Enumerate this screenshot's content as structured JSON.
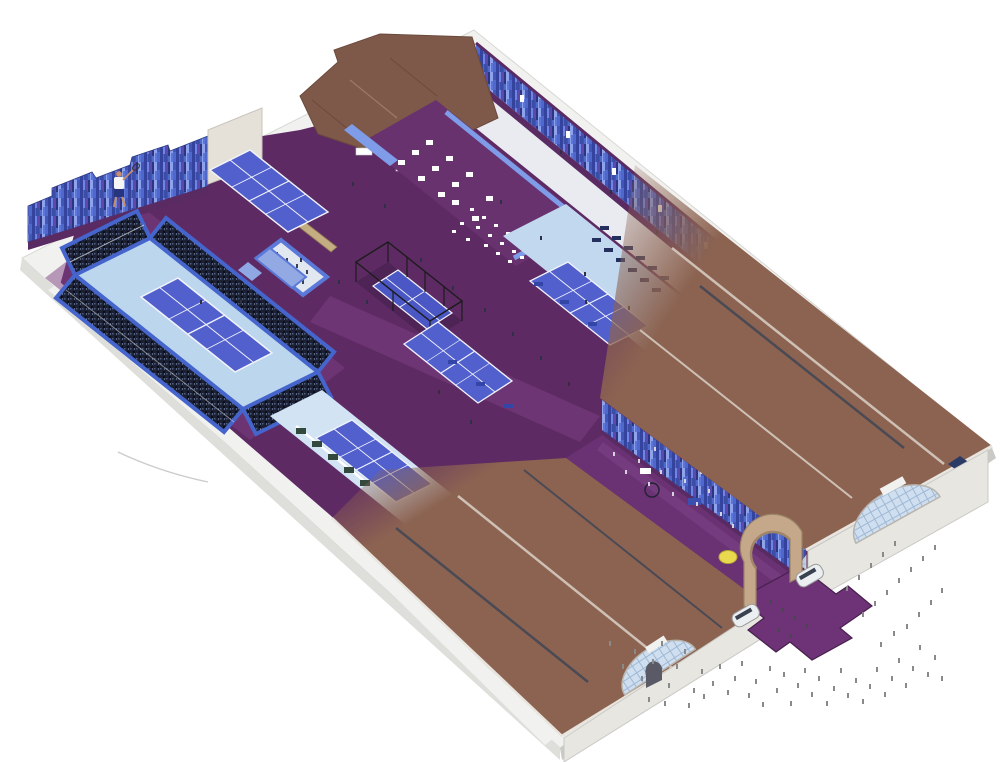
{
  "meta": {
    "description": "Isometric cutaway illustration of an indoor racquet-sports venue: show-court stadium with crowded stands, practice courts, fenced court, cafe seating, purple concourse between brown warehouse roofs, arched entrance with queuing crowds and food trucks"
  },
  "palette": {
    "bg": "#ffffff",
    "concrete_light": "#f1f1ef",
    "concrete_mid": "#dededa",
    "concrete_dark": "#c9c9c5",
    "floor_purple": "#5e2a64",
    "floor_purple_light": "#7b3e82",
    "platform_purple": "#68326f",
    "concourse_purple": "#6a3173",
    "carpet_purple": "#6e3377",
    "purple_band": "#5a2a62",
    "roof_brown": "#8c6351",
    "roof_brown_dark": "#7e5949",
    "roof_ridge": "#cfc0b6",
    "skylight_dark": "#4a4a55",
    "court_blue": "#5260ce",
    "court_blue_deep": "#4b57c4",
    "apron_blue": "#c2d8ee",
    "apron_blue_light": "#d2e3f4",
    "stadium_apron": "#bcd6ee",
    "wall_blue": "#4f68cc",
    "stands_wall": "#4565cd",
    "pale_floor": "#e9ebf1",
    "line_white": "#f2f4fa",
    "fence_black": "#1c1c1c",
    "tan_sand": "#c5ad82",
    "arch_tan": "#c5a88a",
    "arch_tan_dark": "#a08569",
    "ball_yellow": "#e9d94e",
    "figure_gray": "#8a8a8a",
    "figure_dark": "#2f2f45",
    "figure_light": "#d8d2de",
    "figure_carpet": "#4a4550",
    "figure_platform": "#39405c",
    "truck_white": "#eceff1",
    "glaze_blue": "#cfdff0",
    "glaze_line": "#9fb8d4",
    "green_planter": "#33493d",
    "bench_blue": "#3346a8",
    "bench_navy": "#23305e",
    "rail_blue": "#7f9ce8",
    "skin": "#c98e6a",
    "shirt_white": "#f5f5f5",
    "shorts_navy": "#27357f",
    "table_white": "#ffffff"
  },
  "people": {
    "outside": [
      [
        609,
        641
      ],
      [
        622,
        664
      ],
      [
        634,
        649
      ],
      [
        641,
        676
      ],
      [
        652,
        659
      ],
      [
        661,
        641
      ],
      [
        668,
        683
      ],
      [
        676,
        664
      ],
      [
        684,
        649
      ],
      [
        693,
        688
      ],
      [
        701,
        669
      ],
      [
        648,
        697
      ],
      [
        664,
        701
      ],
      [
        688,
        703
      ],
      [
        703,
        694
      ],
      [
        712,
        681
      ],
      [
        719,
        664
      ],
      [
        727,
        690
      ],
      [
        734,
        676
      ],
      [
        741,
        661
      ],
      [
        748,
        693
      ],
      [
        755,
        679
      ],
      [
        762,
        702
      ],
      [
        769,
        666
      ],
      [
        776,
        688
      ],
      [
        783,
        672
      ],
      [
        790,
        701
      ],
      [
        797,
        683
      ],
      [
        804,
        668
      ],
      [
        811,
        692
      ],
      [
        818,
        676
      ],
      [
        826,
        701
      ],
      [
        833,
        686
      ],
      [
        840,
        668
      ],
      [
        847,
        693
      ],
      [
        855,
        678
      ],
      [
        862,
        699
      ],
      [
        869,
        684
      ],
      [
        876,
        667
      ],
      [
        884,
        692
      ],
      [
        891,
        676
      ],
      [
        898,
        658
      ],
      [
        905,
        683
      ],
      [
        912,
        666
      ],
      [
        919,
        645
      ],
      [
        927,
        672
      ],
      [
        934,
        655
      ],
      [
        941,
        676
      ],
      [
        880,
        642
      ],
      [
        893,
        631
      ],
      [
        906,
        624
      ],
      [
        918,
        612
      ],
      [
        930,
        600
      ],
      [
        941,
        588
      ],
      [
        862,
        612
      ],
      [
        874,
        601
      ],
      [
        886,
        590
      ],
      [
        898,
        578
      ],
      [
        910,
        567
      ],
      [
        922,
        556
      ],
      [
        934,
        545
      ],
      [
        846,
        586
      ],
      [
        858,
        575
      ],
      [
        870,
        563
      ],
      [
        882,
        552
      ],
      [
        894,
        541
      ]
    ],
    "concourse": [
      [
        613,
        452
      ],
      [
        625,
        470
      ],
      [
        638,
        459
      ],
      [
        648,
        482
      ],
      [
        660,
        470
      ],
      [
        672,
        492
      ],
      [
        684,
        479
      ],
      [
        696,
        502
      ],
      [
        708,
        489
      ],
      [
        720,
        512
      ],
      [
        732,
        524
      ],
      [
        744,
        536
      ],
      [
        700,
        470
      ],
      [
        654,
        447
      ]
    ],
    "interior": [
      [
        352,
        182
      ],
      [
        384,
        204
      ],
      [
        300,
        258
      ],
      [
        338,
        280
      ],
      [
        366,
        300
      ],
      [
        420,
        258
      ],
      [
        452,
        286
      ],
      [
        484,
        308
      ],
      [
        512,
        332
      ],
      [
        540,
        356
      ],
      [
        568,
        382
      ],
      [
        500,
        200
      ],
      [
        540,
        236
      ],
      [
        584,
        272
      ],
      [
        628,
        306
      ],
      [
        560,
        150
      ],
      [
        610,
        190
      ],
      [
        656,
        230
      ],
      [
        470,
        420
      ],
      [
        438,
        390
      ],
      [
        240,
        300
      ],
      [
        282,
        336
      ],
      [
        200,
        300
      ],
      [
        585,
        300
      ]
    ],
    "platform": [
      [
        276,
        252
      ],
      [
        286,
        258
      ],
      [
        296,
        264
      ],
      [
        306,
        270
      ],
      [
        282,
        268
      ],
      [
        292,
        274
      ],
      [
        302,
        280
      ],
      [
        272,
        262
      ]
    ],
    "carpet": [
      [
        770,
        600
      ],
      [
        782,
        608
      ],
      [
        794,
        616
      ],
      [
        806,
        624
      ],
      [
        778,
        628
      ],
      [
        790,
        634
      ]
    ]
  },
  "furniture": {
    "cafe_tables": [
      [
        398,
        160
      ],
      [
        418,
        176
      ],
      [
        438,
        192
      ],
      [
        412,
        150
      ],
      [
        432,
        166
      ],
      [
        452,
        182
      ],
      [
        426,
        140
      ],
      [
        446,
        156
      ],
      [
        466,
        172
      ],
      [
        452,
        200
      ],
      [
        472,
        216
      ],
      [
        486,
        196
      ]
    ],
    "dining_chairs": [
      [
        470,
        208
      ],
      [
        482,
        216
      ],
      [
        494,
        224
      ],
      [
        506,
        232
      ],
      [
        476,
        226
      ],
      [
        488,
        234
      ],
      [
        500,
        242
      ],
      [
        512,
        250
      ],
      [
        484,
        244
      ],
      [
        496,
        252
      ],
      [
        508,
        260
      ],
      [
        520,
        256
      ],
      [
        460,
        222
      ],
      [
        466,
        238
      ],
      [
        452,
        230
      ],
      [
        524,
        240
      ]
    ],
    "tr_benches": [
      [
        592,
        238
      ],
      [
        604,
        248
      ],
      [
        616,
        258
      ],
      [
        628,
        268
      ],
      [
        640,
        278
      ],
      [
        652,
        288
      ],
      [
        600,
        226
      ],
      [
        612,
        236
      ],
      [
        624,
        246
      ],
      [
        636,
        256
      ],
      [
        648,
        266
      ],
      [
        660,
        276
      ]
    ],
    "court_benches": [
      [
        448,
        360
      ],
      [
        476,
        382
      ],
      [
        504,
        404
      ],
      [
        560,
        300
      ],
      [
        588,
        322
      ],
      [
        534,
        282
      ]
    ],
    "planters": [
      [
        296,
        428
      ],
      [
        312,
        441
      ],
      [
        328,
        454
      ],
      [
        344,
        467
      ],
      [
        360,
        480
      ]
    ],
    "wall_banners": [
      [
        520,
        95
      ],
      [
        566,
        131
      ],
      [
        612,
        168
      ],
      [
        658,
        205
      ],
      [
        704,
        242
      ]
    ]
  }
}
